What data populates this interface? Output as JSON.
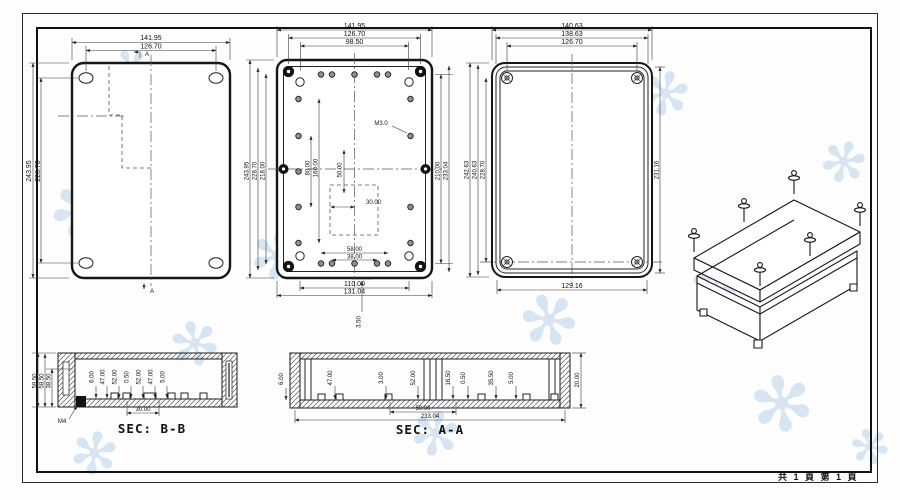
{
  "sheet": {
    "footer": "共 1 頁  第 1 頁"
  },
  "view_front": {
    "section_marker_top": "A",
    "section_marker_bottom": "A",
    "dims": {
      "width_outer": "141.95",
      "width_holes": "126.70",
      "height_outer": "243.95",
      "height_holes": "228.70"
    }
  },
  "view_base": {
    "thread_label": "M3.0",
    "dims": {
      "top": [
        "141.95",
        "126.70",
        "98.50"
      ],
      "left": [
        "243.95",
        "228.70",
        "218.00"
      ],
      "right": [
        "210.00",
        "233.04"
      ],
      "inner": [
        "80.00",
        "160.00",
        "50.00",
        "30.00"
      ],
      "bottom": [
        "58.00",
        "38.00",
        "110.00",
        "131.04"
      ],
      "lip": "3.50"
    }
  },
  "view_lid": {
    "dims": {
      "top": [
        "140.63",
        "138.63",
        "126.70"
      ],
      "left": [
        "242.63",
        "240.63",
        "228.70"
      ],
      "right": "231.16",
      "bottom": "129.16"
    }
  },
  "section_bb": {
    "title": "SEC: B-B",
    "insert_label": "M4",
    "dims": {
      "left": [
        "59.50",
        "58.50",
        "38.50"
      ],
      "inner": [
        "6.00",
        "47.00",
        "52.00",
        "0.50",
        "52.00",
        "47.00",
        "5.00"
      ],
      "bottom": "30.00"
    }
  },
  "section_aa": {
    "title": "SEC: A-A",
    "dims": {
      "left": "6.00",
      "inner": [
        "47.00",
        "3.00",
        "52.00",
        "16.50",
        "0.50",
        "35.50",
        "5.00"
      ],
      "bottom": [
        "50.00",
        "233.04"
      ],
      "right": "20.00"
    }
  }
}
